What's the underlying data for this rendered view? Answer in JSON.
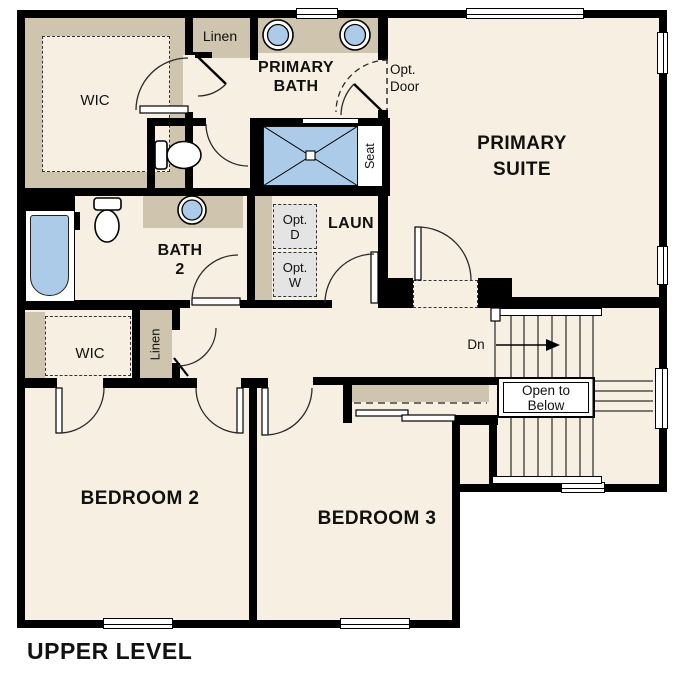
{
  "title": "UPPER LEVEL",
  "colors": {
    "floor": "#f6efe2",
    "wall": "#000000",
    "cabinet": "#cfc4ae",
    "fixture": "#abcbe9",
    "optional_fill": "#e4e4e4",
    "outline": "#2b2b2b"
  },
  "rooms": {
    "wic1": {
      "label": "WIC"
    },
    "linen1": {
      "label": "Linen"
    },
    "primary_bath": {
      "line1": "PRIMARY",
      "line2": "BATH"
    },
    "primary_suite": {
      "line1": "PRIMARY",
      "line2": "SUITE"
    },
    "bath2": {
      "line1": "BATH",
      "line2": "2"
    },
    "laundry": {
      "label": "LAUN"
    },
    "wic2": {
      "label": "WIC"
    },
    "linen2": {
      "label": "Linen"
    },
    "bedroom2": {
      "label": "BEDROOM 2"
    },
    "bedroom3": {
      "label": "BEDROOM 3"
    }
  },
  "annotations": {
    "opt_door": {
      "line1": "Opt.",
      "line2": "Door"
    },
    "opt_dryer": {
      "line1": "Opt.",
      "line2": "D"
    },
    "opt_washer": {
      "line1": "Opt.",
      "line2": "W"
    },
    "seat": {
      "label": "Seat"
    },
    "stairs_down": {
      "label": "Dn"
    },
    "open_to_below": {
      "line1": "Open to",
      "line2": "Below"
    }
  }
}
